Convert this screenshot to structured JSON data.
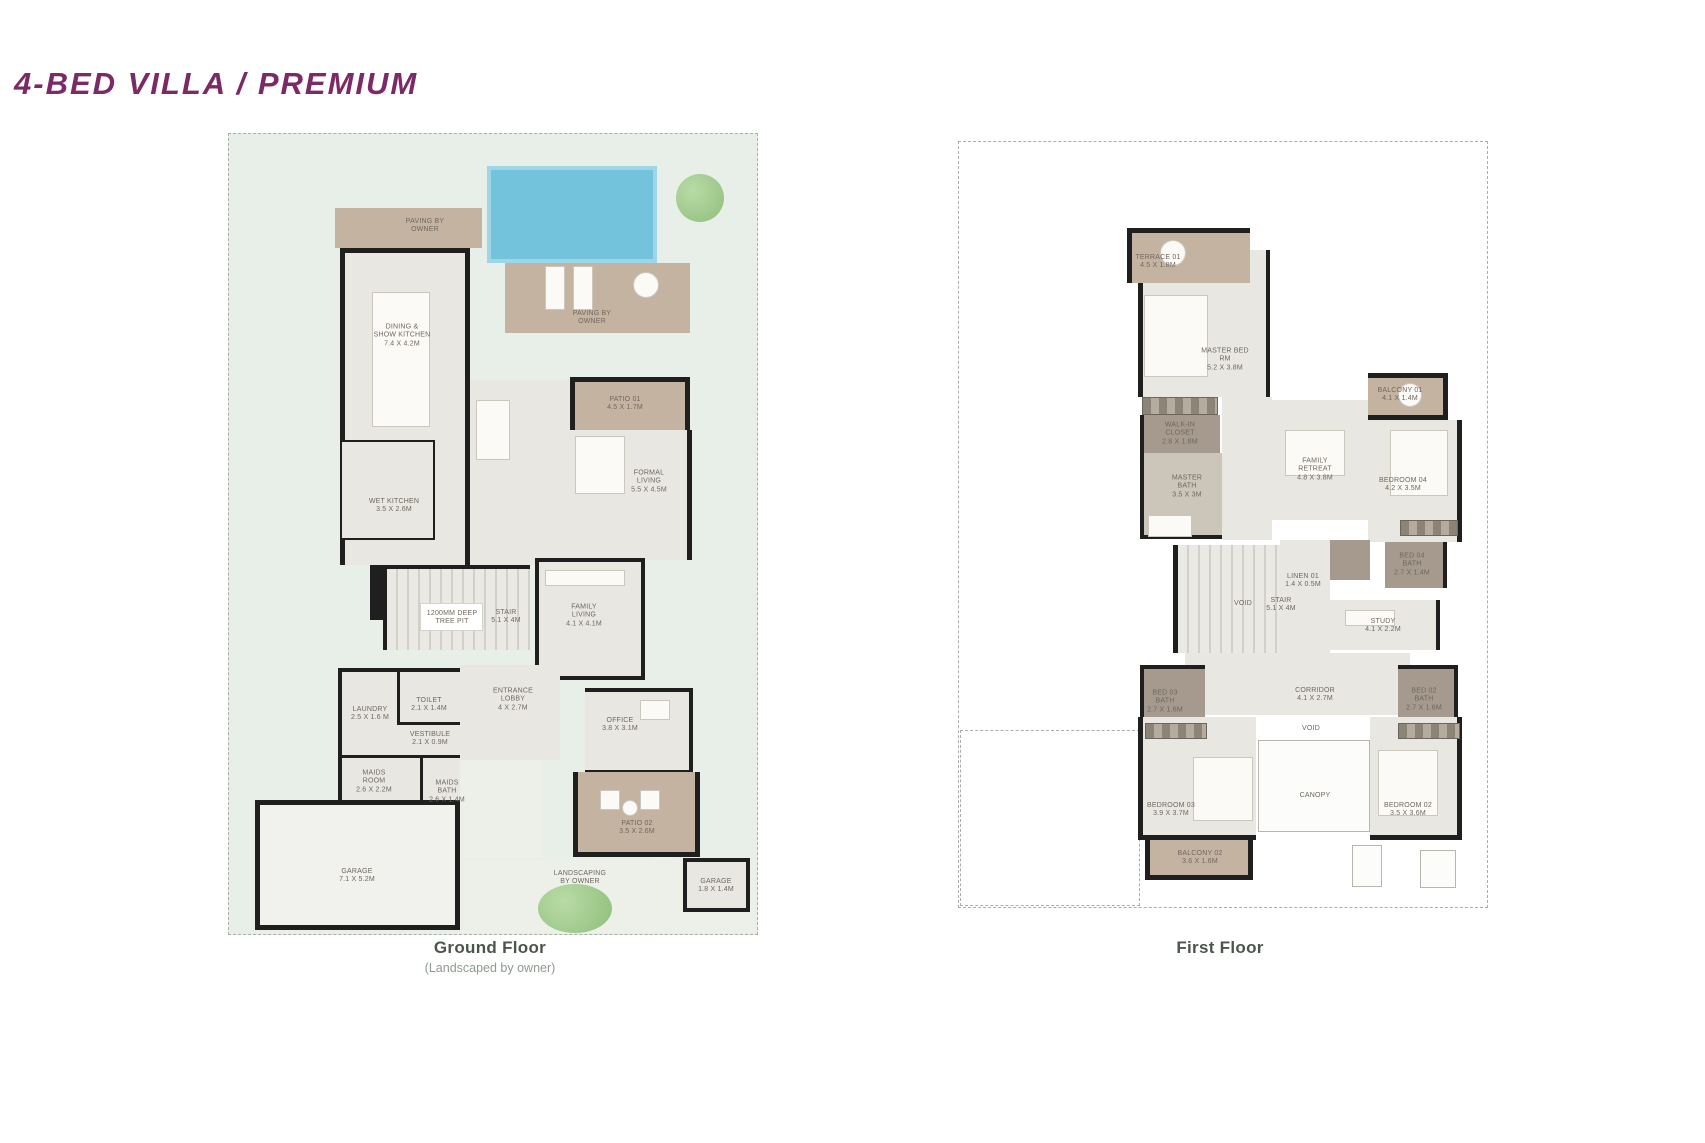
{
  "title": "4-BED VILLA / PREMIUM",
  "colors": {
    "accent_purple": "#7b2a66",
    "caption_green": "#4b564b",
    "lawn_green": "#e8efe8",
    "patio_tan": "#c5b3a2",
    "pool_blue": "#74c3dc",
    "wall_black": "#1f1f1f"
  },
  "floors": [
    {
      "id": "ground-floor",
      "caption": "Ground Floor",
      "subcaption": "(Landscaped by owner)",
      "caption_pos": {
        "x": 490,
        "y": 938
      },
      "plot": {
        "x": 228,
        "y": 133,
        "w": 530,
        "h": 802,
        "fill": "#e8efe8"
      },
      "shapes": [
        {
          "name": "driveway",
          "x": 460,
          "y": 860,
          "w": 296,
          "h": 73,
          "fill": "pave2"
        },
        {
          "name": "side-path",
          "x": 652,
          "y": 690,
          "w": 26,
          "h": 243,
          "fill": "pave2"
        },
        {
          "name": "entry-walk",
          "x": 455,
          "y": 758,
          "w": 88,
          "h": 100,
          "fill": "pave2"
        },
        {
          "name": "pool",
          "x": 487,
          "y": 166,
          "w": 170,
          "h": 97,
          "fill": "pool"
        },
        {
          "name": "pool-deck",
          "x": 505,
          "y": 263,
          "w": 185,
          "h": 70,
          "fill": "tan"
        },
        {
          "name": "paving-terrace",
          "x": 335,
          "y": 208,
          "w": 147,
          "h": 40,
          "fill": "tan"
        },
        {
          "name": "dining-wing",
          "x": 340,
          "y": 248,
          "w": 130,
          "h": 317,
          "fill": "room",
          "borders": "tlr",
          "bw": 5
        },
        {
          "name": "center-hall",
          "x": 470,
          "y": 380,
          "w": 100,
          "h": 185,
          "fill": "room"
        },
        {
          "name": "patio-01",
          "x": 570,
          "y": 377,
          "w": 120,
          "h": 53,
          "fill": "tan",
          "borders": "tlr",
          "bw": 5
        },
        {
          "name": "formal-living",
          "x": 565,
          "y": 430,
          "w": 127,
          "h": 130,
          "fill": "room",
          "borders": "r",
          "bw": 5
        },
        {
          "name": "wet-kitchen",
          "x": 342,
          "y": 440,
          "w": 93,
          "h": 100,
          "fill": "room",
          "borders": "trb",
          "bw": 2
        },
        {
          "name": "stair",
          "x": 383,
          "y": 565,
          "w": 147,
          "h": 85,
          "fill": "stair",
          "borders": "tl",
          "bw": 4
        },
        {
          "name": "stair-wall",
          "x": 370,
          "y": 565,
          "w": 13,
          "h": 55,
          "fill": "wall"
        },
        {
          "name": "tree-pit",
          "x": 420,
          "y": 603,
          "w": 63,
          "h": 28,
          "fill": "white"
        },
        {
          "name": "family-living",
          "x": 535,
          "y": 558,
          "w": 110,
          "h": 122,
          "fill": "room",
          "borders": "tlrb",
          "bw": 4
        },
        {
          "name": "service-block",
          "x": 338,
          "y": 668,
          "w": 122,
          "h": 137,
          "fill": "room",
          "borders": "tlb",
          "bw": 4
        },
        {
          "name": "laundry-divider",
          "x": 397,
          "y": 670,
          "w": 3,
          "h": 55,
          "fill": "wall"
        },
        {
          "name": "toilet-divider",
          "x": 400,
          "y": 722,
          "w": 60,
          "h": 3,
          "fill": "wall"
        },
        {
          "name": "maids-divider",
          "x": 338,
          "y": 755,
          "w": 122,
          "h": 3,
          "fill": "wall"
        },
        {
          "name": "maids-bath-divider",
          "x": 420,
          "y": 757,
          "w": 3,
          "h": 48,
          "fill": "wall"
        },
        {
          "name": "entrance-lobby",
          "x": 460,
          "y": 665,
          "w": 100,
          "h": 95,
          "fill": "room"
        },
        {
          "name": "office",
          "x": 585,
          "y": 688,
          "w": 108,
          "h": 86,
          "fill": "room",
          "borders": "trb",
          "bw": 4
        },
        {
          "name": "patio-02",
          "x": 573,
          "y": 772,
          "w": 127,
          "h": 85,
          "fill": "tan",
          "borders": "lrb",
          "bw": 5
        },
        {
          "name": "garage",
          "x": 255,
          "y": 800,
          "w": 205,
          "h": 130,
          "fill": "garage",
          "borders": "tlrb",
          "bw": 5
        },
        {
          "name": "mini-garage",
          "x": 683,
          "y": 858,
          "w": 67,
          "h": 54,
          "fill": "room",
          "borders": "tlrb",
          "bw": 4
        },
        {
          "name": "dining-table",
          "x": 372,
          "y": 292,
          "w": 58,
          "h": 135,
          "fill": "furn"
        },
        {
          "name": "lounger",
          "x": 545,
          "y": 266,
          "w": 20,
          "h": 44,
          "fill": "furn"
        },
        {
          "name": "lounger",
          "x": 573,
          "y": 266,
          "w": 20,
          "h": 44,
          "fill": "furn"
        },
        {
          "name": "deck-table",
          "x": 633,
          "y": 272,
          "w": 26,
          "h": 26,
          "fill": "furn",
          "round": 1
        },
        {
          "name": "sofa",
          "x": 476,
          "y": 400,
          "w": 34,
          "h": 60,
          "fill": "furn"
        },
        {
          "name": "sofa",
          "x": 575,
          "y": 436,
          "w": 50,
          "h": 58,
          "fill": "furn"
        },
        {
          "name": "sofa",
          "x": 545,
          "y": 570,
          "w": 80,
          "h": 16,
          "fill": "furn"
        },
        {
          "name": "desk",
          "x": 640,
          "y": 700,
          "w": 30,
          "h": 20,
          "fill": "furn"
        },
        {
          "name": "patio-chair",
          "x": 600,
          "y": 790,
          "w": 20,
          "h": 20,
          "fill": "furn"
        },
        {
          "name": "patio-chair",
          "x": 640,
          "y": 790,
          "w": 20,
          "h": 20,
          "fill": "furn"
        },
        {
          "name": "patio-table",
          "x": 622,
          "y": 800,
          "w": 16,
          "h": 16,
          "fill": "furn",
          "round": 1
        },
        {
          "name": "tree",
          "x": 676,
          "y": 174,
          "w": 48,
          "h": 48,
          "fill": "tree"
        },
        {
          "name": "tree",
          "x": 538,
          "y": 884,
          "w": 74,
          "h": 49,
          "fill": "tree"
        }
      ],
      "labels": [
        {
          "x": 425,
          "y": 226,
          "text": "PAVING BY\nOWNER"
        },
        {
          "x": 402,
          "y": 336,
          "text": "DINING &\nSHOW KITCHEN\n7.4 X 4.2M"
        },
        {
          "x": 592,
          "y": 318,
          "text": "PAVING BY\nOWNER"
        },
        {
          "x": 625,
          "y": 404,
          "text": "PATIO 01\n4.5 X 1.7M"
        },
        {
          "x": 649,
          "y": 482,
          "text": "FORMAL\nLIVING\n5.5 X 4.5M"
        },
        {
          "x": 394,
          "y": 506,
          "text": "WET KITCHEN\n3.5 X 2.6M"
        },
        {
          "x": 452,
          "y": 618,
          "text": "1200MM DEEP\nTREE PIT"
        },
        {
          "x": 506,
          "y": 617,
          "text": "STAIR\n5.1 X 4M"
        },
        {
          "x": 584,
          "y": 616,
          "text": "FAMILY\nLIVING\n4.1 X 4.1M"
        },
        {
          "x": 370,
          "y": 714,
          "text": "LAUNDRY\n2.5 X 1.6 M"
        },
        {
          "x": 429,
          "y": 705,
          "text": "TOILET\n2.1 X 1.4M"
        },
        {
          "x": 430,
          "y": 739,
          "text": "VESTIBULE\n2.1 X 0.9M"
        },
        {
          "x": 513,
          "y": 700,
          "text": "ENTRANCE\nLOBBY\n4 X 2.7M"
        },
        {
          "x": 620,
          "y": 725,
          "text": "OFFICE\n3.8 X 3.1M"
        },
        {
          "x": 374,
          "y": 782,
          "text": "MAIDS\nROOM\n2.6 X 2.2M"
        },
        {
          "x": 447,
          "y": 792,
          "text": "MAIDS\nBATH\n2.6 X 1.4M"
        },
        {
          "x": 637,
          "y": 828,
          "text": "PATIO 02\n3.5 X 2.6M"
        },
        {
          "x": 580,
          "y": 878,
          "text": "LANDSCAPING\nBY OWNER"
        },
        {
          "x": 357,
          "y": 876,
          "text": "GARAGE\n7.1 X 5.2M"
        },
        {
          "x": 716,
          "y": 886,
          "text": "GARAGE\n1.8 X 1.4M"
        }
      ]
    },
    {
      "id": "first-floor",
      "caption": "First Floor",
      "subcaption": "",
      "caption_pos": {
        "x": 1220,
        "y": 938
      },
      "plot": {
        "x": 958,
        "y": 141,
        "w": 530,
        "h": 767,
        "fill": "#ffffff"
      },
      "shapes": [
        {
          "name": "garden-box",
          "x": 960,
          "y": 730,
          "w": 180,
          "h": 176,
          "fill": "dashedbox"
        },
        {
          "name": "terrace-01",
          "x": 1127,
          "y": 228,
          "w": 123,
          "h": 55,
          "fill": "tan",
          "borders": "tl",
          "bw": 5
        },
        {
          "name": "master-bed",
          "x": 1138,
          "y": 283,
          "w": 127,
          "h": 114,
          "fill": "room",
          "borders": "lr",
          "bw": 5
        },
        {
          "name": "master-col",
          "x": 1250,
          "y": 250,
          "w": 20,
          "h": 147,
          "fill": "room",
          "borders": "r",
          "bw": 4
        },
        {
          "name": "walkin-shelf",
          "x": 1142,
          "y": 397,
          "w": 76,
          "h": 18,
          "fill": "hatch"
        },
        {
          "name": "walkin-closet",
          "x": 1140,
          "y": 415,
          "w": 80,
          "h": 38,
          "fill": "dark",
          "borders": "l",
          "bw": 4
        },
        {
          "name": "master-bath",
          "x": 1140,
          "y": 453,
          "w": 82,
          "h": 86,
          "fill": "mid",
          "borders": "lb",
          "bw": 4
        },
        {
          "name": "hallway",
          "x": 1222,
          "y": 397,
          "w": 50,
          "h": 143,
          "fill": "room"
        },
        {
          "name": "family-retreat",
          "x": 1268,
          "y": 400,
          "w": 100,
          "h": 120,
          "fill": "room"
        },
        {
          "name": "balcony-01",
          "x": 1368,
          "y": 373,
          "w": 80,
          "h": 47,
          "fill": "tan",
          "borders": "trb",
          "bw": 5
        },
        {
          "name": "bedroom-04",
          "x": 1368,
          "y": 420,
          "w": 94,
          "h": 122,
          "fill": "room",
          "borders": "r",
          "bw": 5
        },
        {
          "name": "wardrobe",
          "x": 1400,
          "y": 520,
          "w": 58,
          "h": 16,
          "fill": "hatch"
        },
        {
          "name": "bed04-bath",
          "x": 1385,
          "y": 542,
          "w": 62,
          "h": 46,
          "fill": "dark",
          "borders": "r",
          "bw": 4
        },
        {
          "name": "toilet",
          "x": 1330,
          "y": 540,
          "w": 40,
          "h": 40,
          "fill": "dark"
        },
        {
          "name": "linen",
          "x": 1280,
          "y": 540,
          "w": 50,
          "h": 113,
          "fill": "room"
        },
        {
          "name": "stair",
          "x": 1173,
          "y": 545,
          "w": 107,
          "h": 108,
          "fill": "stair",
          "borders": "l",
          "bw": 5
        },
        {
          "name": "study",
          "x": 1330,
          "y": 600,
          "w": 110,
          "h": 50,
          "fill": "room",
          "borders": "r",
          "bw": 4
        },
        {
          "name": "corridor",
          "x": 1185,
          "y": 653,
          "w": 225,
          "h": 62,
          "fill": "room"
        },
        {
          "name": "bed03-bath",
          "x": 1140,
          "y": 665,
          "w": 65,
          "h": 52,
          "fill": "dark",
          "borders": "tl",
          "bw": 4
        },
        {
          "name": "bed02-bath",
          "x": 1398,
          "y": 665,
          "w": 60,
          "h": 52,
          "fill": "dark",
          "borders": "tr",
          "bw": 4
        },
        {
          "name": "bedroom-03",
          "x": 1138,
          "y": 717,
          "w": 118,
          "h": 123,
          "fill": "room",
          "borders": "lb",
          "bw": 5
        },
        {
          "name": "canopy",
          "x": 1258,
          "y": 740,
          "w": 112,
          "h": 92,
          "fill": "canopy"
        },
        {
          "name": "bedroom-02",
          "x": 1370,
          "y": 717,
          "w": 92,
          "h": 123,
          "fill": "room",
          "borders": "rb",
          "bw": 5
        },
        {
          "name": "balcony-02",
          "x": 1145,
          "y": 840,
          "w": 108,
          "h": 40,
          "fill": "tan",
          "borders": "lrb",
          "bw": 5
        },
        {
          "name": "wardrobe",
          "x": 1145,
          "y": 723,
          "w": 62,
          "h": 16,
          "fill": "hatch"
        },
        {
          "name": "wardrobe",
          "x": 1398,
          "y": 723,
          "w": 62,
          "h": 16,
          "fill": "hatch"
        },
        {
          "name": "bed",
          "x": 1144,
          "y": 295,
          "w": 64,
          "h": 82,
          "fill": "furn"
        },
        {
          "name": "bed",
          "x": 1193,
          "y": 757,
          "w": 60,
          "h": 64,
          "fill": "furn"
        },
        {
          "name": "bed",
          "x": 1378,
          "y": 750,
          "w": 60,
          "h": 66,
          "fill": "furn"
        },
        {
          "name": "bed",
          "x": 1390,
          "y": 430,
          "w": 58,
          "h": 66,
          "fill": "furn"
        },
        {
          "name": "sofa",
          "x": 1285,
          "y": 430,
          "w": 60,
          "h": 46,
          "fill": "furn"
        },
        {
          "name": "bathtub",
          "x": 1148,
          "y": 515,
          "w": 44,
          "h": 22,
          "fill": "furn"
        },
        {
          "name": "desk",
          "x": 1345,
          "y": 610,
          "w": 50,
          "h": 16,
          "fill": "furn"
        },
        {
          "name": "terrace-table",
          "x": 1160,
          "y": 240,
          "w": 26,
          "h": 26,
          "fill": "furn",
          "round": 1
        },
        {
          "name": "balcony-table",
          "x": 1398,
          "y": 383,
          "w": 24,
          "h": 24,
          "fill": "furn",
          "round": 1
        },
        {
          "name": "utility-box",
          "x": 1352,
          "y": 845,
          "w": 30,
          "h": 42,
          "fill": "canopy"
        },
        {
          "name": "utility-box",
          "x": 1420,
          "y": 850,
          "w": 36,
          "h": 38,
          "fill": "canopy"
        }
      ],
      "labels": [
        {
          "x": 1158,
          "y": 262,
          "text": "TERRACE 01\n4.5 X 1.8M"
        },
        {
          "x": 1225,
          "y": 360,
          "text": "MASTER BED\nRM\n5.2 X 3.8M"
        },
        {
          "x": 1400,
          "y": 395,
          "text": "BALCONY 01\n4.1 X 1.4M"
        },
        {
          "x": 1180,
          "y": 434,
          "text": "WALK-IN\nCLOSET\n2.8 X 1.8M"
        },
        {
          "x": 1187,
          "y": 487,
          "text": "MASTER\nBATH\n3.5 X 3M"
        },
        {
          "x": 1315,
          "y": 470,
          "text": "FAMILY\nRETREAT\n4.8 X 3.8M"
        },
        {
          "x": 1403,
          "y": 485,
          "text": "BEDROOM 04\n4.2 X 3.5M"
        },
        {
          "x": 1412,
          "y": 565,
          "text": "BED 04\nBATH\n2.7 X 1.4M"
        },
        {
          "x": 1303,
          "y": 581,
          "text": "LINEN 01\n1.4 X 0.5M"
        },
        {
          "x": 1243,
          "y": 604,
          "text": "VOID"
        },
        {
          "x": 1281,
          "y": 605,
          "text": "STAIR\n5.1 X 4M"
        },
        {
          "x": 1383,
          "y": 626,
          "text": "STUDY\n4.1 X 2.2M"
        },
        {
          "x": 1165,
          "y": 702,
          "text": "BED 03\nBATH\n2.7 X 1.6M"
        },
        {
          "x": 1315,
          "y": 695,
          "text": "CORRIDOR\n4.1 X 2.7M"
        },
        {
          "x": 1424,
          "y": 700,
          "text": "BED 02\nBATH\n2.7 X 1.6M"
        },
        {
          "x": 1311,
          "y": 729,
          "text": "VOID"
        },
        {
          "x": 1171,
          "y": 810,
          "text": "BEDROOM 03\n3.9 X 3.7M"
        },
        {
          "x": 1315,
          "y": 796,
          "text": "CANOPY"
        },
        {
          "x": 1408,
          "y": 810,
          "text": "BEDROOM 02\n3.5 X 3.6M"
        },
        {
          "x": 1200,
          "y": 858,
          "text": "BALCONY 02\n3.6 X 1.6M"
        }
      ]
    }
  ]
}
